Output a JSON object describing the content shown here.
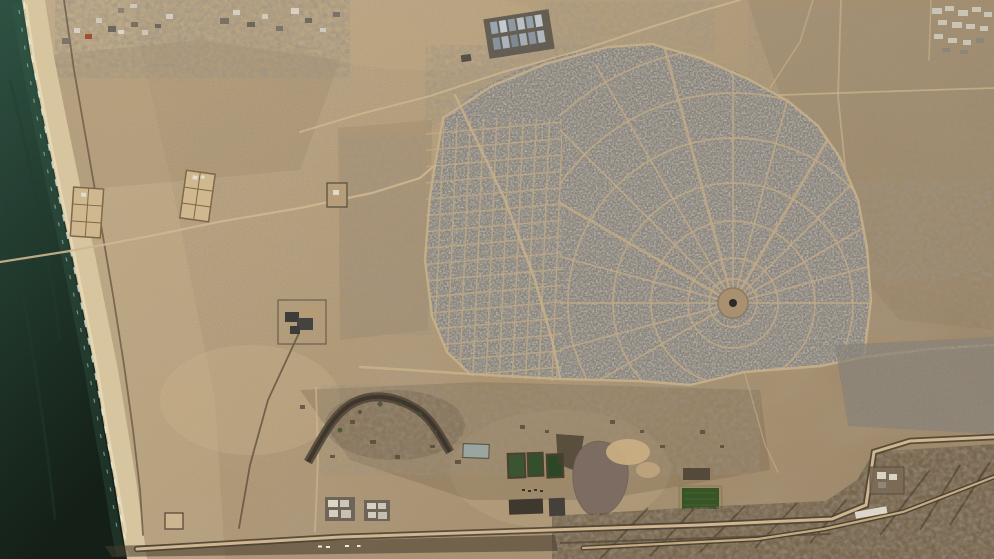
{
  "meta": {
    "view": "satellite-imagery",
    "scene": "coastal desert city with a fan-shaped street plan, sea and beach on the west, fortified border corridor along the south edge"
  },
  "colors": {
    "sea_deep": "#141f17",
    "sea_shallow": "#2e5243",
    "surf_foam": "#e8efe6",
    "beach": "#d7c5a0",
    "beach_edge": "#e9dcba",
    "sand_light": "#c6b08a",
    "sand_mid": "#b59d78",
    "sand_dark": "#9d8564",
    "urban_base": "#8d867a",
    "urban_block": "#3b3836",
    "street": "#c3ab85",
    "road_light": "#cdb690",
    "road_dark": "#4c3f31",
    "coast_track": "#6f5d48",
    "pond_green": "#3a5530",
    "field_green": "#375426",
    "basin_gray": "#9aa5a0",
    "mound_mauve": "#7d6c62",
    "dune": "#c9ad82",
    "corridor_dark": "#574835",
    "white_structure": "#e7e2d5"
  },
  "features": [
    {
      "id": "sea",
      "desc": "dark green sea with surf lines along the shore"
    },
    {
      "id": "beach",
      "desc": "bright sand beach strip running diagonally down the west side"
    },
    {
      "id": "urban-fan-district",
      "desc": "dense grey city laid out as radial and ring streets around a circular plaza"
    },
    {
      "id": "grid-district",
      "desc": "rectilinear grid quarter on the west side of the city"
    },
    {
      "id": "central-plaza",
      "desc": "circular open plaza at the hub of the radial streets"
    },
    {
      "id": "warehouse-compound",
      "desc": "rows of blue-grey warehouse roofs near the top centre"
    },
    {
      "id": "walled-enclosures",
      "desc": "two rectangular walled enclosures with internal partitions on the west plain"
    },
    {
      "id": "treatment-ponds",
      "desc": "three dark green rectangular basins near the bottom centre"
    },
    {
      "id": "sludge-basins",
      "desc": "dark rectangular basins south of the ponds"
    },
    {
      "id": "water-basin",
      "desc": "pale grey rectangular basin"
    },
    {
      "id": "earth-mound",
      "desc": "large grey-mauve spoil mound beside the ponds"
    },
    {
      "id": "sand-dune",
      "desc": "bright sand dune next to the mound"
    },
    {
      "id": "crop-field",
      "desc": "dark green rectangular field near the bottom right"
    },
    {
      "id": "wadi-channel",
      "desc": "dark meandering channel south of the city"
    },
    {
      "id": "border-corridor",
      "desc": "dark graded strip with parallel roads along the bottom, kinking north near the east edge"
    },
    {
      "id": "coastal-road",
      "desc": "dark track following the shoreline"
    },
    {
      "id": "greenhouse-cluster",
      "desc": "pale rectangular structures in the northeast corner"
    },
    {
      "id": "building-clusters",
      "desc": "scattered small buildings and ruins across the sand"
    }
  ]
}
